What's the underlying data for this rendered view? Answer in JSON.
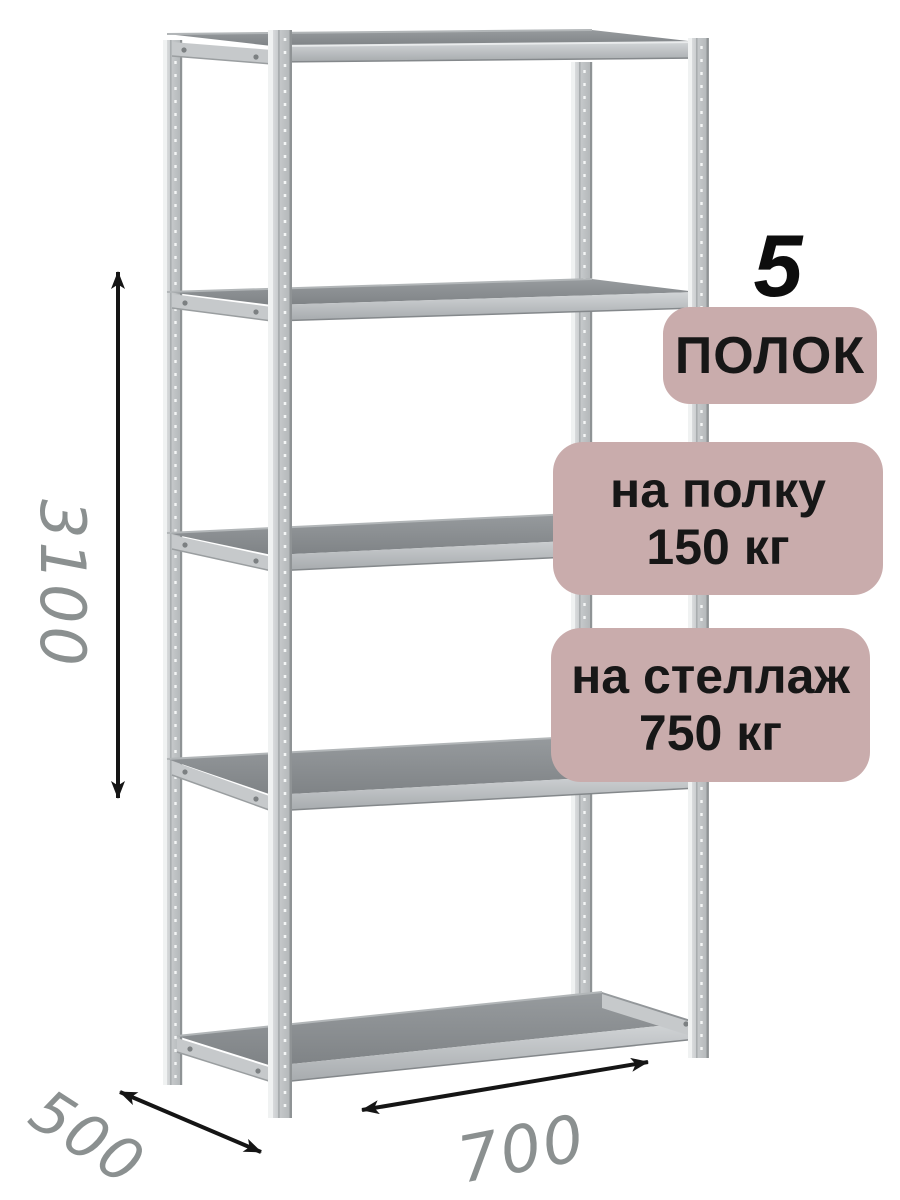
{
  "badges": {
    "shelf_count": {
      "number": "5",
      "label": "ПОЛОК"
    },
    "per_shelf": {
      "line1": "на полку",
      "line2": "150 кг"
    },
    "per_rack": {
      "line1": "на стеллаж",
      "line2": "750 кг"
    }
  },
  "dimensions": {
    "height_mm": "3100",
    "width_mm": "700",
    "depth_mm": "500"
  },
  "colors": {
    "badge_bg": "#c9acac",
    "badge_text": "#171717",
    "dim_text": "#8b9090",
    "arrow": "#151515",
    "shelf_top": "#85898c",
    "metal_light": "#d9dcdd"
  }
}
